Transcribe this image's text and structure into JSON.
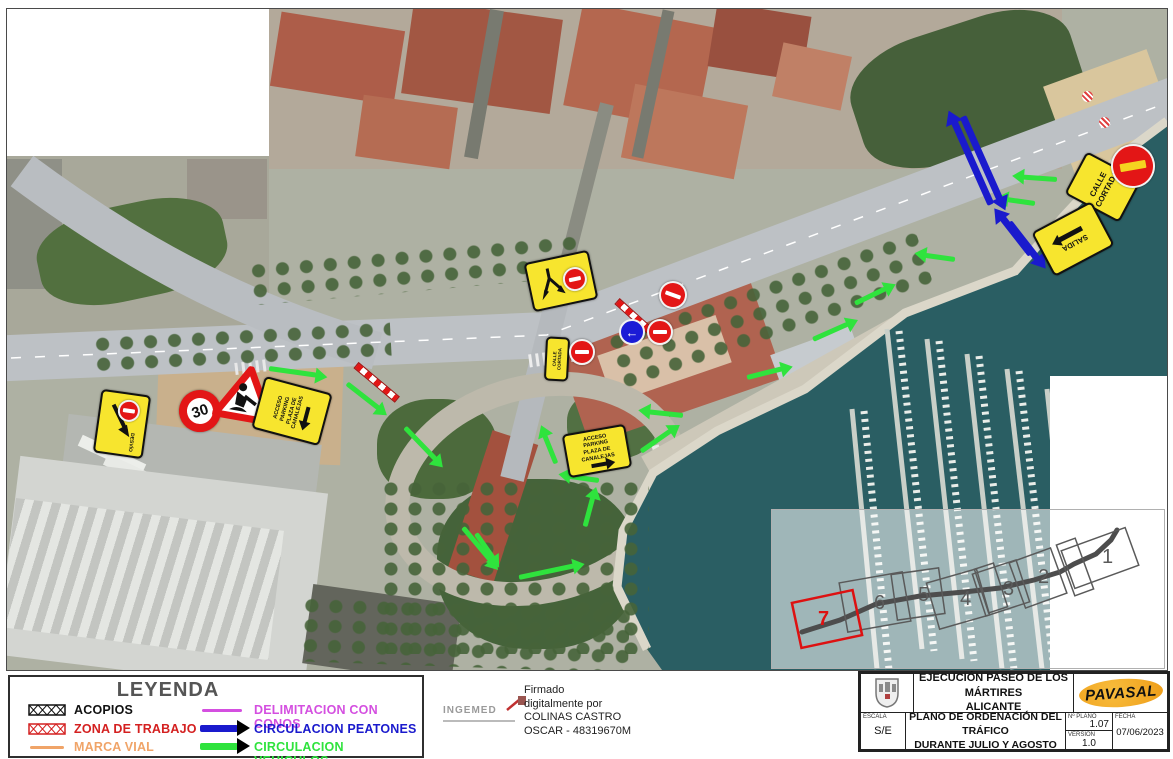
{
  "page": {
    "width": 1173,
    "height": 759
  },
  "colors": {
    "vehicle_green": "#2fe33d",
    "pedestrian_blue": "#1a1acd",
    "no_entry_red": "#e31616",
    "sign_yellow": "#f7e52e",
    "cones_magenta": "#d44fe0",
    "marca_orange": "#f0a468",
    "work_zone_red": "#d42020",
    "index_highlight_red": "#dd1111",
    "pavasal_yellow": "#f0a822",
    "sea_teal": "#2a5e63"
  },
  "legend": {
    "title": "LEYENDA",
    "items": [
      {
        "label": "ACOPIOS",
        "color": "#111111",
        "symbol": "hatched-rect"
      },
      {
        "label": "ZONA DE TRABAJO",
        "color": "#d42020",
        "symbol": "hatched-rect"
      },
      {
        "label": "MARCA VIAL",
        "color": "#f0a468",
        "symbol": "line"
      },
      {
        "label": "DELIMITACION CON CONOS",
        "color": "#d44fe0",
        "symbol": "line"
      },
      {
        "label": "CIRCULACION PEATONES",
        "color": "#1a1acd",
        "symbol": "arrow"
      },
      {
        "label": "CIRCULACION VEHICULOS",
        "color": "#2fe33d",
        "symbol": "arrow"
      }
    ]
  },
  "signature": {
    "logo": "INGEMED",
    "lines": "Firmado\ndigitalmente por\nCOLINAS CASTRO\nOSCAR - 48319670M"
  },
  "title_block": {
    "project": "EJECUCIÓN PASEO DE LOS MÁRTIRES\nALICANTE",
    "company": "PAVASAL",
    "scale_label": "ESCALA",
    "scale": "S/E",
    "drawing": "PLANO DE ORDENACIÓN DEL TRÁFICO\nDURANTE JULIO Y AGOSTO",
    "plan_label": "Nº PLANO",
    "plan": "1.07",
    "version_label": "VERSIÓN",
    "version": "1.0",
    "date_label": "FECHA",
    "date": "07/06/2023"
  },
  "map": {
    "signs": {
      "calle_cortada": "CALLE\nCORTADA",
      "salida": "SALIDA",
      "acceso_parking": "ACCESO\nPARKING\nPLAZA DE CANALEJAS",
      "speed_limit": "30",
      "desvio": "DESVÍO"
    },
    "index": {
      "labels": [
        "1",
        "2",
        "3",
        "4",
        "5",
        "6",
        "7"
      ]
    }
  }
}
